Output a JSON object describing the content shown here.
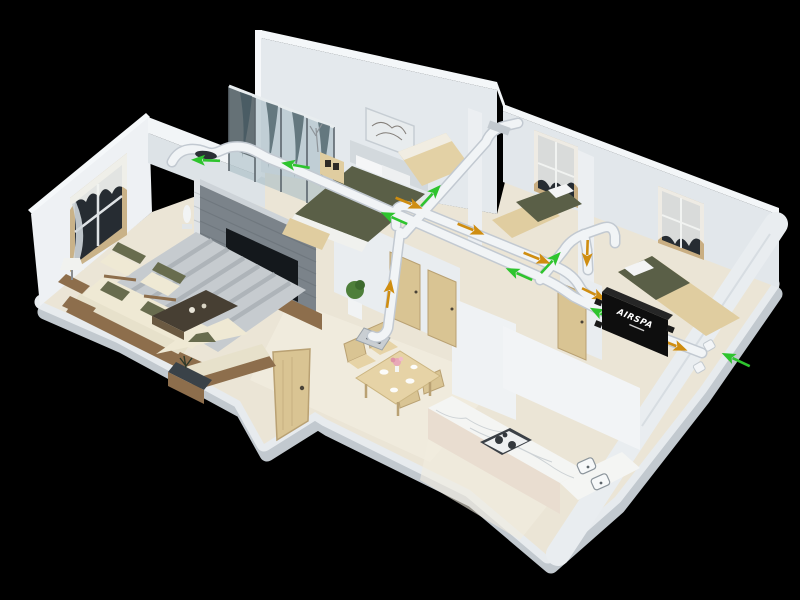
{
  "scene": {
    "description": "3D isometric cutaway rendering of an apartment with a ducted fresh-air heat-recovery ventilation system",
    "background_color": "#000000",
    "view": "isometric cutaway, black background"
  },
  "branding": {
    "unit_label": "AIRSPA"
  },
  "ventilation": {
    "unit_type": "heat recovery ventilation unit",
    "unit_location": "corner bedroom against right exterior wall",
    "supply_air_color": "#2ec42e",
    "exhaust_air_color": "#cf8d10",
    "duct_color": "#f1f4f6",
    "duct_edge_color": "#c2c9d1",
    "supply_arrow_count": 8,
    "exhaust_arrow_count": 7,
    "exterior_wall_vents": 2,
    "airflow_legend": {
      "green_arrows": "fresh supply air to rooms",
      "orange_arrows": "stale exhaust air back to unit and outside"
    }
  },
  "rooms": [
    {
      "name": "living room",
      "items": [
        "sofa",
        "loveseat",
        "two armchairs",
        "coffee table",
        "striped rug",
        "table lamp",
        "TV on stone accent wall",
        "curtained window",
        "planter"
      ]
    },
    {
      "name": "master bedroom",
      "items": [
        "double bed with olive duvet",
        "headboard",
        "wall art",
        "nightstand",
        "glass partition",
        "foot bench"
      ]
    },
    {
      "name": "middle bedroom",
      "items": [
        "single bed"
      ]
    },
    {
      "name": "bedroom two",
      "items": [
        "bed",
        "curtained window"
      ]
    },
    {
      "name": "corner bedroom",
      "items": [
        "bed",
        "curtained window",
        "AIRSPA ventilation unit"
      ]
    },
    {
      "name": "dining area",
      "items": [
        "wooden dining table",
        "four chairs",
        "plates",
        "pink flower vase"
      ]
    },
    {
      "name": "kitchen",
      "items": [
        "marble counter",
        "gas hob",
        "double sink"
      ]
    },
    {
      "name": "hallway",
      "items": [
        "three wooden doors",
        "standing open door",
        "ceiling diffuser"
      ]
    }
  ],
  "colors": {
    "floor": "#ebe5d6",
    "floor_light": "#f4f0e3",
    "slab_rim": "#e7ebee",
    "slab_shadow": "#c2c9cf",
    "wall_light": "#eef1f4",
    "wall_mid": "#e2e7eb",
    "wall_top": "#f5f8fa",
    "stone_wall": "#7b838a",
    "tv_screen": "#14181c",
    "wood_dark": "#8d6e4c",
    "wood_light": "#e0cda0",
    "door_wood": "#d9c493",
    "cushion": "#e7e1cb",
    "olive": "#5a5f47",
    "rug": "#c6cbcf",
    "rug_stripe": "#aeb4b9",
    "glass": "#a9bcc4",
    "window_pane": "#262c32",
    "marble": "#f4f5f3",
    "cabinet_front": "#e9ddd0",
    "unit_body": "#0e0e0e",
    "curtain": "#f2f4f1"
  }
}
